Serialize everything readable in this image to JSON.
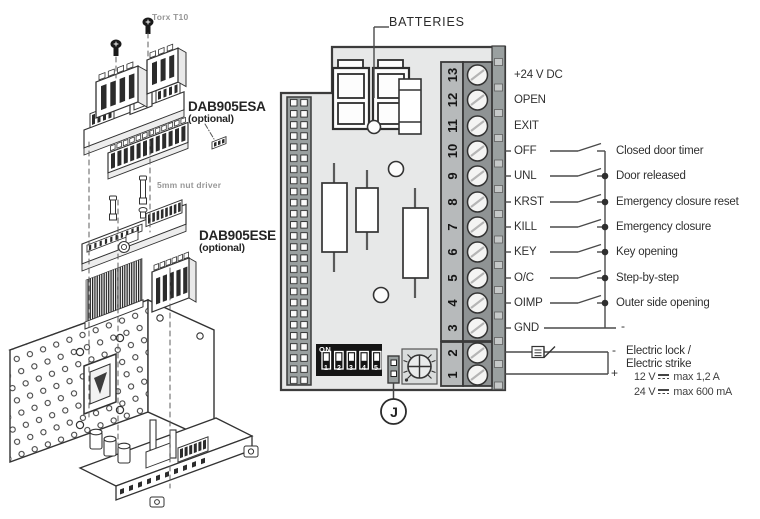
{
  "exploded_view": {
    "screw_tool": "Torx T10",
    "nut_tool": "5mm nut driver",
    "module_top": {
      "name": "DAB905ESA",
      "note": "(optional)"
    },
    "module_bottom": {
      "name": "DAB905ESE",
      "note": "(optional)"
    }
  },
  "control_board": {
    "batteries_label": "BATTERIES",
    "jumper_label": "J",
    "dip_switch": {
      "on_label": "ON",
      "positions": [
        "1",
        "2",
        "3",
        "4",
        "5"
      ]
    },
    "terminal_numbers_lock": [
      "2",
      "1"
    ]
  },
  "wiring": {
    "rows": [
      {
        "terminal": "13",
        "signal": "+24 V DC",
        "has_switch": false,
        "description": ""
      },
      {
        "terminal": "12",
        "signal": "OPEN",
        "has_switch": false,
        "description": ""
      },
      {
        "terminal": "11",
        "signal": "EXIT",
        "has_switch": false,
        "description": ""
      },
      {
        "terminal": "10",
        "signal": "OFF",
        "has_switch": true,
        "description": "Closed door timer"
      },
      {
        "terminal": "9",
        "signal": "UNL",
        "has_switch": true,
        "description": "Door released"
      },
      {
        "terminal": "8",
        "signal": "KRST",
        "has_switch": true,
        "description": "Emergency closure reset"
      },
      {
        "terminal": "7",
        "signal": "KILL",
        "has_switch": true,
        "description": "Emergency closure"
      },
      {
        "terminal": "6",
        "signal": "KEY",
        "has_switch": true,
        "description": "Key opening"
      },
      {
        "terminal": "5",
        "signal": "O/C",
        "has_switch": true,
        "description": "Step-by-step"
      },
      {
        "terminal": "4",
        "signal": "OIMP",
        "has_switch": true,
        "description": "Outer side opening"
      },
      {
        "terminal": "3",
        "signal": "GND",
        "has_switch": false,
        "description": "-"
      }
    ],
    "lock": {
      "negative": "-",
      "positive": "+",
      "name_line1": "Electric lock /",
      "name_line2": "Electric strike",
      "spec_12v": {
        "voltage": "12 V",
        "rating": "max 1,2 A"
      },
      "spec_24v": {
        "voltage": "24 V",
        "rating": "max 600 mA"
      }
    }
  },
  "colors": {
    "board_fill": "#e7e8e8",
    "terminal_number_strip": "#b7babb",
    "terminal_screw_strip": "#8f9394",
    "pin_header": "#9aa0a0",
    "dip_body": "#151515",
    "wire_line": "#4a4a4a"
  }
}
